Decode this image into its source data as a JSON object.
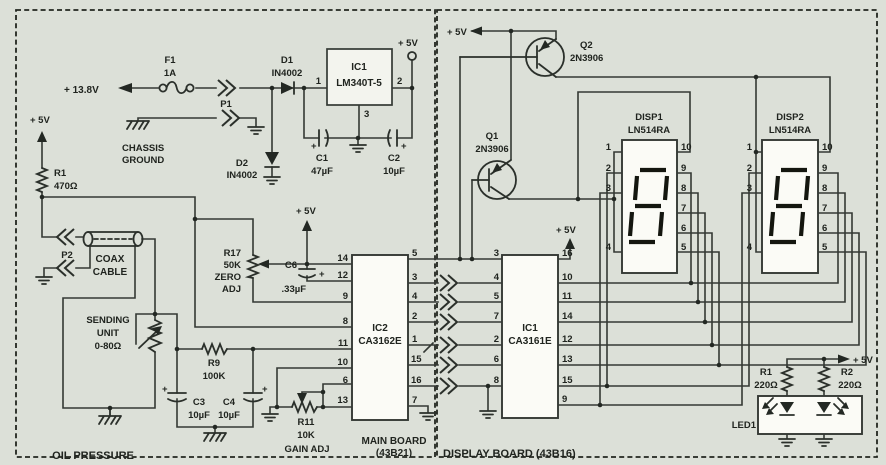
{
  "labels": {
    "oil_pressure": "OIL PRESSURE",
    "main_board": "MAIN BOARD",
    "main_board_id": "(43B21)",
    "display_board": "DISPLAY BOARD (43B16)"
  },
  "power": {
    "vin": "+ 13.8V",
    "v5": "+ 5V"
  },
  "sym": {
    "plus": "+"
  },
  "components": {
    "f1": {
      "ref": "F1",
      "val": "1A"
    },
    "p1": {
      "ref": "P1"
    },
    "p2": {
      "ref": "P2"
    },
    "d1": {
      "ref": "D1",
      "val": "IN4002"
    },
    "d2": {
      "ref": "D2",
      "val": "IN4002"
    },
    "reg": {
      "ref": "IC1",
      "val": "LM340T-5",
      "pin_in": "1",
      "pin_out": "2",
      "pin_gnd": "3"
    },
    "c1": {
      "ref": "C1",
      "val": "47µF"
    },
    "c2": {
      "ref": "C2",
      "val": "10µF"
    },
    "chassis": {
      "l1": "CHASSIS",
      "l2": "GROUND"
    },
    "r1m": {
      "ref": "R1",
      "val": "470Ω"
    },
    "coax": {
      "l1": "COAX",
      "l2": "CABLE"
    },
    "sender": {
      "l1": "SENDING",
      "l2": "UNIT",
      "l3": "0-80Ω"
    },
    "r17": {
      "ref": "R17",
      "val": "50K",
      "adj1": "ZERO",
      "adj2": "ADJ"
    },
    "c6": {
      "ref": "C6",
      "val": ".33µF"
    },
    "r9": {
      "ref": "R9",
      "val": "100K"
    },
    "c3": {
      "ref": "C3",
      "val": "10µF"
    },
    "c4": {
      "ref": "C4",
      "val": "10µF"
    },
    "r11": {
      "ref": "R11",
      "val": "10K",
      "adj": "GAIN ADJ"
    },
    "ic2": {
      "ref": "IC2",
      "val": "CA3162E",
      "lp": [
        "14",
        "12",
        "9",
        "8",
        "11",
        "10",
        "6",
        "13"
      ],
      "rp": [
        "5",
        "3",
        "4",
        "2",
        "1",
        "15",
        "16",
        "7"
      ]
    },
    "ic1d": {
      "ref": "IC1",
      "val": "CA3161E",
      "lp": [
        "3",
        "4",
        "5",
        "7",
        "2",
        "6",
        "8"
      ],
      "rp": [
        "16",
        "10",
        "11",
        "14",
        "12",
        "13",
        "15",
        "9"
      ]
    },
    "q1": {
      "ref": "Q1",
      "val": "2N3906"
    },
    "q2": {
      "ref": "Q2",
      "val": "2N3906"
    },
    "disp1": {
      "ref": "DISP1",
      "val": "LN514RA",
      "lp": [
        "1",
        "2",
        "3",
        "4"
      ],
      "rp": [
        "10",
        "9",
        "8",
        "7",
        "6",
        "5"
      ]
    },
    "disp2": {
      "ref": "DISP2",
      "val": "LN514RA",
      "lp": [
        "1",
        "2",
        "3",
        "4"
      ],
      "rp": [
        "10",
        "9",
        "8",
        "7",
        "6",
        "5"
      ]
    },
    "r1d": {
      "ref": "R1",
      "val": "220Ω"
    },
    "r2d": {
      "ref": "R2",
      "val": "220Ω"
    },
    "led1": {
      "ref": "LED1"
    }
  }
}
